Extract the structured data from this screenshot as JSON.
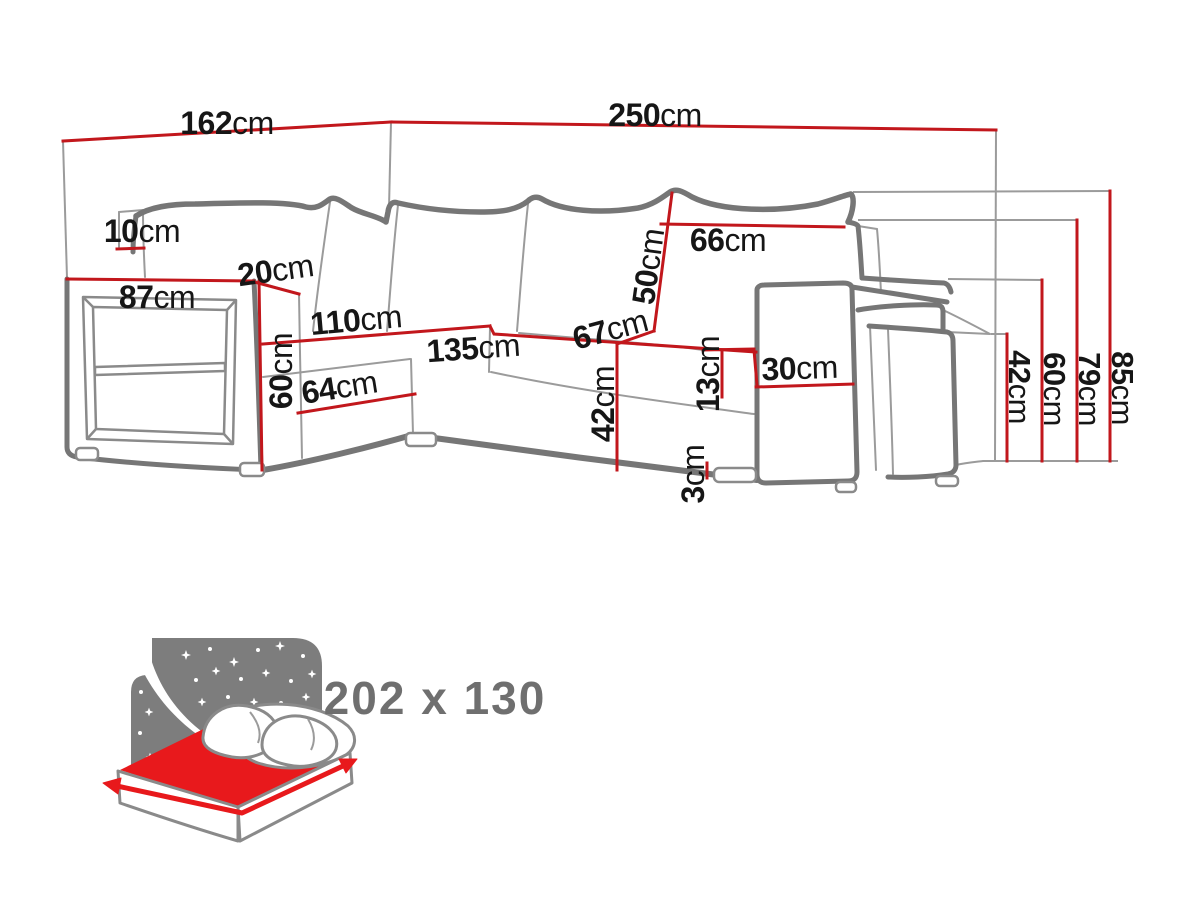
{
  "page": {
    "background": "#ffffff"
  },
  "colors": {
    "dimension_line_red": "#c2171c",
    "drawing_outline_gray": "#767676",
    "drawing_light_gray": "#9b9b9b",
    "label_text": "#161616",
    "icon_sky_gray": "#7d7d7d",
    "icon_red": "#e8191c",
    "size_text_gray": "#6f6f6f"
  },
  "dimensions": {
    "left_width": {
      "value": "162",
      "unit": "cm"
    },
    "right_width": {
      "value": "250",
      "unit": "cm"
    },
    "backrest_top_depth": {
      "value": "10",
      "unit": "cm"
    },
    "armrest_top_depth": {
      "value": "20",
      "unit": "cm"
    },
    "armrest_length": {
      "value": "87",
      "unit": "cm"
    },
    "back_cushion_width": {
      "value": "66",
      "unit": "cm"
    },
    "back_cushion_height": {
      "value": "50",
      "unit": "cm"
    },
    "seat_length_left": {
      "value": "110",
      "unit": "cm"
    },
    "seat_length_front": {
      "value": "135",
      "unit": "cm"
    },
    "seat_depth": {
      "value": "67",
      "unit": "cm"
    },
    "chaise_front_length": {
      "value": "64",
      "unit": "cm"
    },
    "left_armrest_height": {
      "value": "60",
      "unit": "cm"
    },
    "seat_height": {
      "value": "42",
      "unit": "cm"
    },
    "armrest_above_seat": {
      "value": "13",
      "unit": "cm"
    },
    "right_armrest_width": {
      "value": "30",
      "unit": "cm"
    },
    "foot_height": {
      "value": "3",
      "unit": "cm"
    },
    "pouf_height": {
      "value": "42",
      "unit": "cm"
    },
    "right_armrest_height": {
      "value": "60",
      "unit": "cm"
    },
    "backrest_frame_height": {
      "value": "79",
      "unit": "cm"
    },
    "total_height": {
      "value": "85",
      "unit": "cm"
    }
  },
  "sleeping_area": {
    "size": "202 x 130"
  }
}
